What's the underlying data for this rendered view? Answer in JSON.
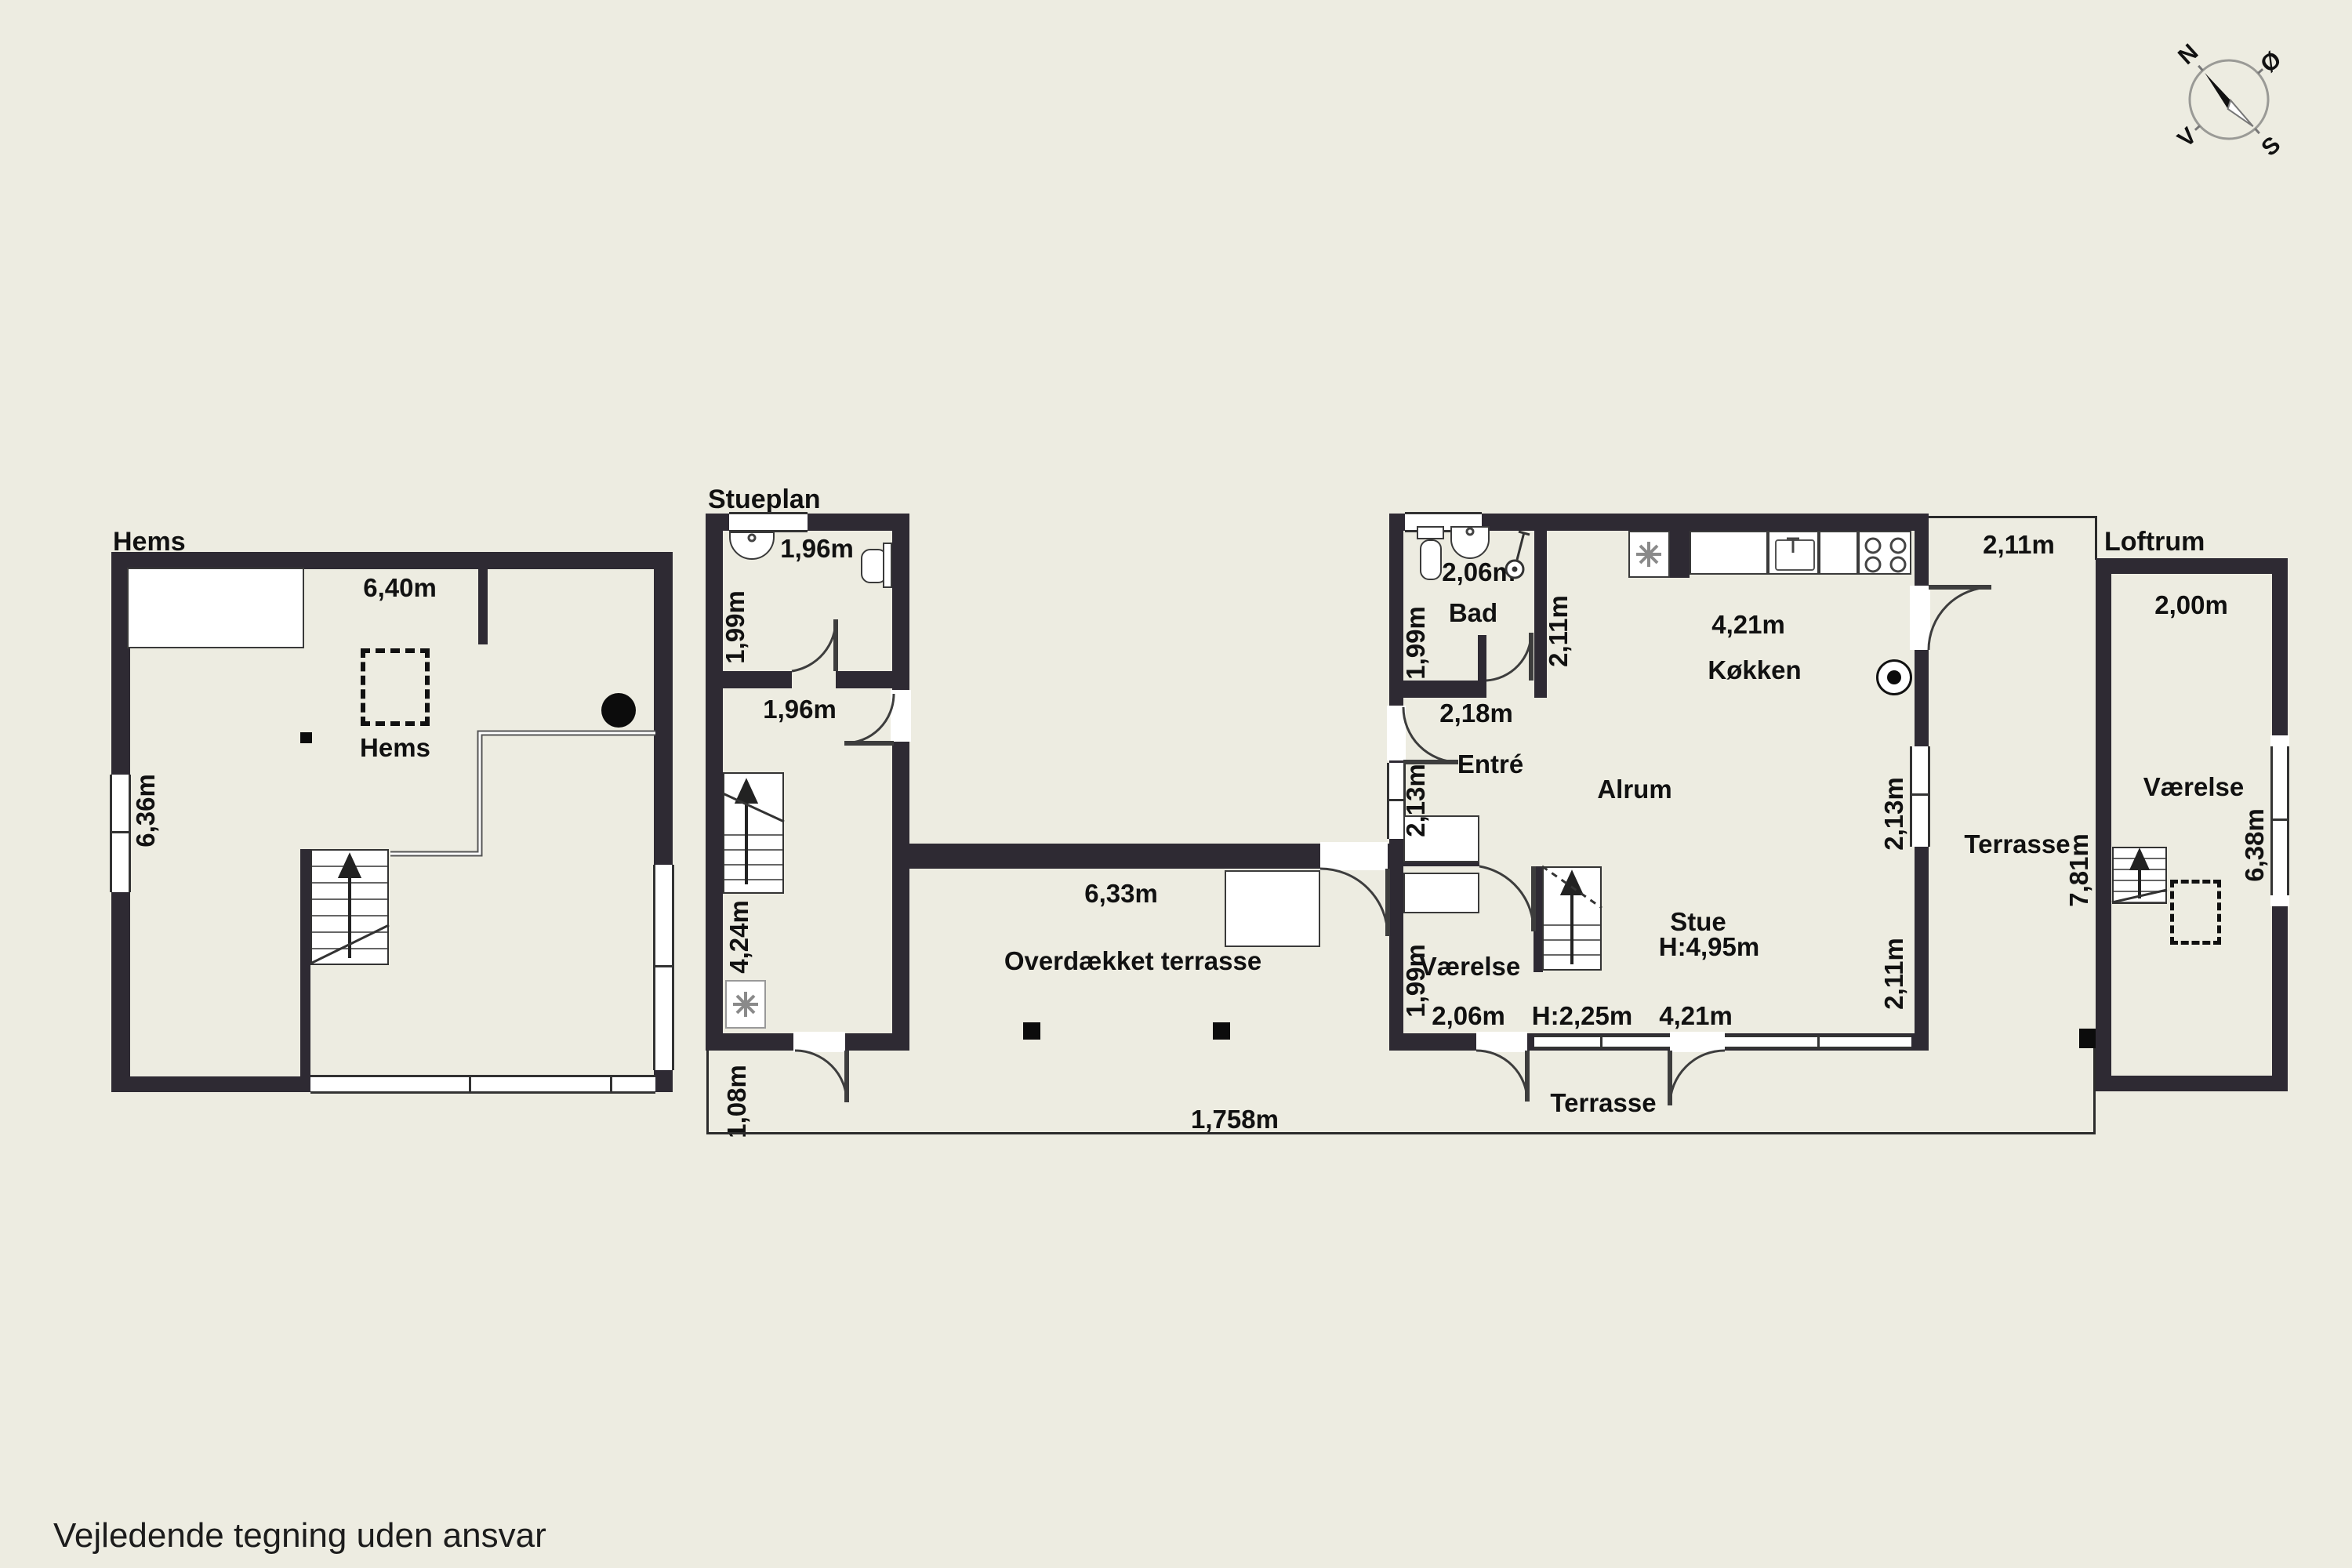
{
  "colors": {
    "background": "#EDECE1",
    "wall": "#2E2A33",
    "line": "#2b2b2b",
    "fixture_border": "#3a3a3a"
  },
  "footer": {
    "disclaimer": "Vejledende tegning uden ansvar"
  },
  "compass": {
    "north": "N",
    "east": "Ø",
    "south": "S",
    "west": "V"
  },
  "hems": {
    "title": "Hems",
    "room_label": "Hems",
    "width_dim": "6,40m",
    "depth_dim": "6,36m"
  },
  "stueplan": {
    "title": "Stueplan",
    "bath_width_dim": "1,96m",
    "bath_depth_dim": "1,99m",
    "hall_width_dim": "1,96m",
    "stair_depth_dim": "4,24m",
    "door_dim": "1,08m"
  },
  "covered_terrace": {
    "label": "Overdækket terrasse",
    "wall_dim": "6,33m",
    "total_dim": "1,758m"
  },
  "main": {
    "bad_label": "Bad",
    "bad_width_dim": "2,06m",
    "bad_depth_dim": "1,99m",
    "bad_right_dim": "2,11m",
    "hall_dim": "2,18m",
    "entre_label": "Entré",
    "left_window_dim": "2,13m",
    "alrum_label": "Alrum",
    "kitchen_dim": "4,21m",
    "kokken_label": "Køkken",
    "terrace_top_dim": "2,11m",
    "terrasse_right_label": "Terrasse",
    "right_window_dim": "2,13m",
    "right_lower_dim": "2,11m",
    "stue_label": "Stue",
    "stue_height": "H:4,95m",
    "vaerelse_label": "Værelse",
    "vaerelse_depth_dim": "1,99m",
    "vaerelse_width_dim": "2,06m",
    "stair_height": "H:2,25m",
    "stue_south_dim": "4,21m",
    "terrasse_south_label": "Terrasse",
    "terrace_side_dim": "7,81m"
  },
  "loftrum": {
    "title": "Loftrum",
    "width_dim": "2,00m",
    "vaerelse_label": "Værelse",
    "depth_dim": "6,38m"
  }
}
